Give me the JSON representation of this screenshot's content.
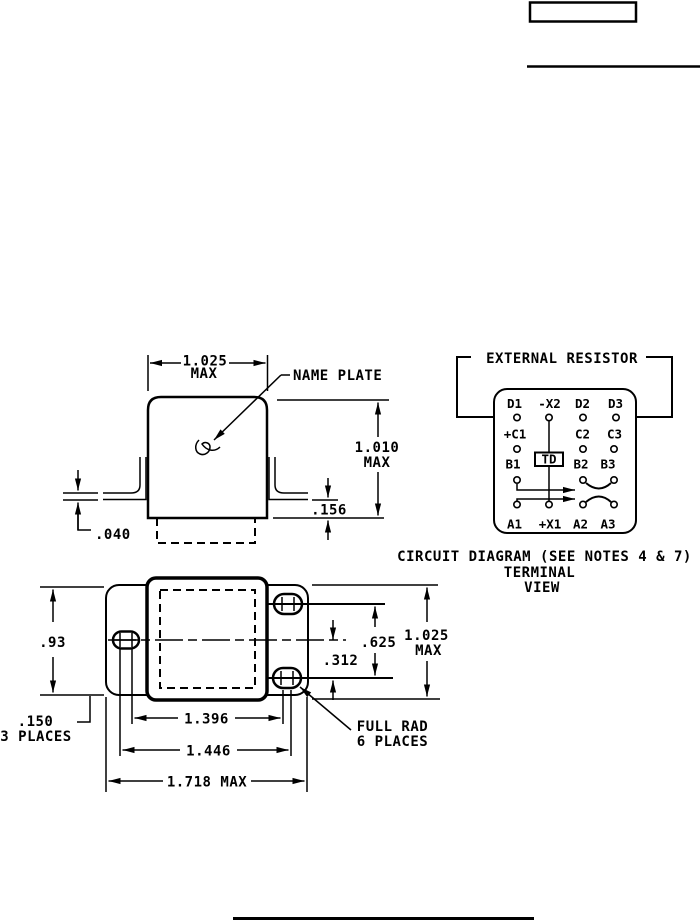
{
  "colors": {
    "ink": "#000000",
    "paper": "#ffffff"
  },
  "side_view": {
    "width_dim": "1.025",
    "width_dim_qual": "MAX",
    "name_plate": "NAME PLATE",
    "height_dim": "1.010",
    "height_dim_qual": "MAX",
    "standoff_dim": ".156",
    "flange_thickness_dim": ".040"
  },
  "circuit_diagram": {
    "external_resistor": "EXTERNAL RESISTOR",
    "timer_label": "TD",
    "terminals": {
      "d1": "D1",
      "x2_neg": "-X2",
      "d2": "D2",
      "d3": "D3",
      "c1_pos": "+C1",
      "c2": "C2",
      "c3": "C3",
      "b1": "B1",
      "b2": "B2",
      "b3": "B3",
      "a1": "A1",
      "x1_pos": "+X1",
      "a2": "A2",
      "a3": "A3"
    },
    "caption_line1": "CIRCUIT DIAGRAM (SEE NOTES 4 & 7)",
    "caption_line2": "TERMINAL",
    "caption_line3": "VIEW"
  },
  "bottom_view": {
    "flange_height_dim": ".93",
    "slot_width_dim": ".150",
    "slot_width_note": "3 PLACES",
    "hole_span_inner_dim": "1.396",
    "hole_span_outer_dim": "1.446",
    "overall_width_dim": "1.718 MAX",
    "center_offset_dim": ".312",
    "hole_pitch_dim": ".625",
    "body_height_dim": "1.025",
    "body_height_dim_qual": "MAX",
    "full_rad_note_line1": "FULL RAD",
    "full_rad_note_line2": "6 PLACES"
  }
}
